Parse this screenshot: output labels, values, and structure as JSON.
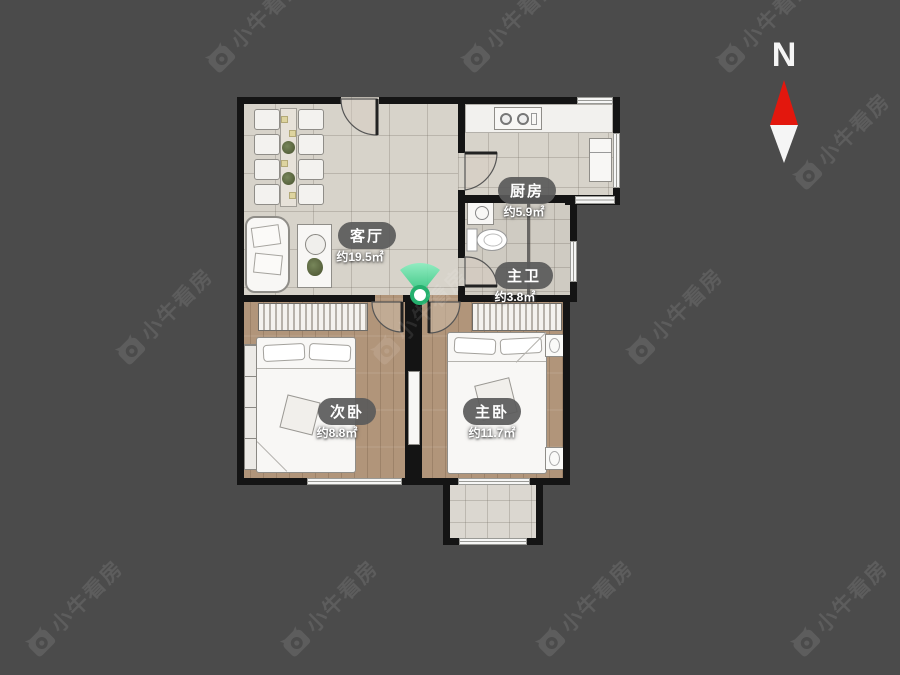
{
  "page": {
    "background_color": "#4b4b4b"
  },
  "watermark": {
    "text": "小牛看房"
  },
  "compass": {
    "north_label": "N",
    "needle_red": "#e3170d",
    "needle_white": "#f5f5f5"
  },
  "marker": {
    "type": "viewpoint",
    "color": "#2bbd76"
  },
  "rooms": [
    {
      "key": "living-room",
      "name": "客厅",
      "area": "约19.5㎡"
    },
    {
      "key": "kitchen",
      "name": "厨房",
      "area": "约5.9㎡"
    },
    {
      "key": "master-bathroom",
      "name": "主卫",
      "area": "约3.8㎡"
    },
    {
      "key": "second-bedroom",
      "name": "次卧",
      "area": "约8.8㎡"
    },
    {
      "key": "master-bedroom",
      "name": "主卧",
      "area": "约11.7㎡"
    }
  ],
  "colors": {
    "wall": "#141414",
    "tile_floor": "#d7d3ca",
    "wood_floor": "#b1957a"
  }
}
